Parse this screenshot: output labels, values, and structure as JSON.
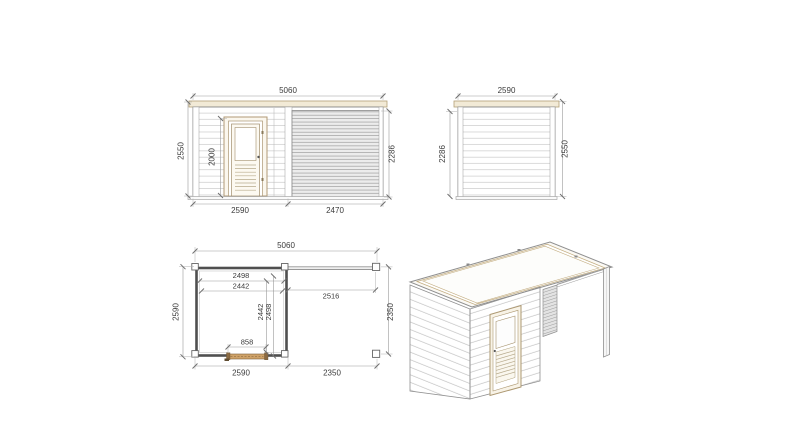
{
  "drawing": {
    "subject": "garden-house-with-pergola-technical-drawing",
    "colors": {
      "background": "#ffffff",
      "outline": "#8a8a8a",
      "dim_line": "#9a9a9a",
      "dim_text": "#3b3b3b",
      "wall_dark": "#4f4f4f",
      "wood_trim": "#b09a76",
      "roof_band": "#f2ead6",
      "slat_fill": "#ececec",
      "plan_door_fill": "#cfa268"
    }
  },
  "dims": {
    "front": {
      "overall_width": "5060",
      "height_left": "2550",
      "door_height": "2000",
      "slat_height": "2286",
      "bottom_cabin": "2590",
      "bottom_pergola": "2470"
    },
    "side": {
      "width": "2590",
      "height_left": "2286",
      "height_right": "2550"
    },
    "plan": {
      "overall_width": "5060",
      "top_inner_a": "2498",
      "top_inner_b": "2442",
      "pergola_span": "2516",
      "depth_left": "2590",
      "inner_depth_a": "2442",
      "inner_depth_b": "2498",
      "door_width": "858",
      "depth_right": "2350",
      "bottom_cabin": "2590",
      "bottom_pergola": "2350"
    }
  }
}
